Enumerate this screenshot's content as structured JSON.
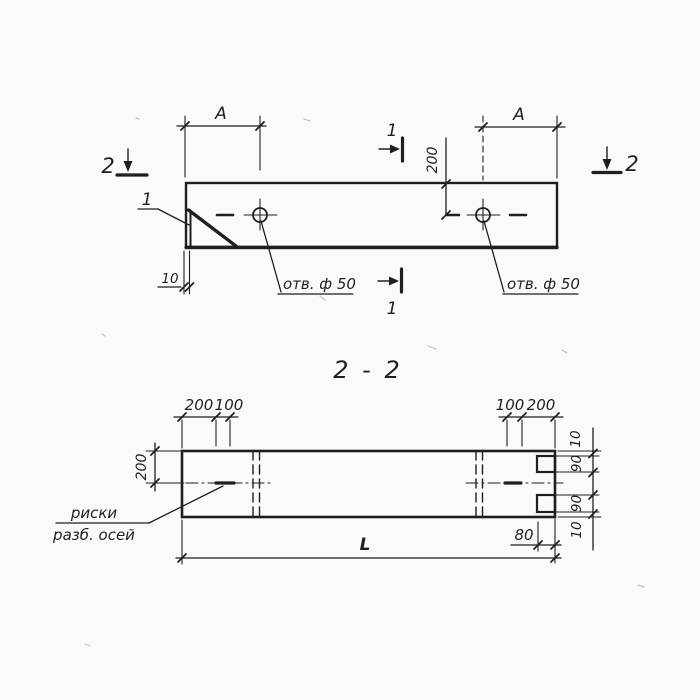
{
  "colors": {
    "background": "#fbfaf7",
    "ink": "#201f1d"
  },
  "top_view": {
    "section_cut_2_left": "2",
    "section_cut_2_right": "2",
    "section_cut_1_top": "1",
    "section_cut_1_bottom": "1",
    "detail_callout": "1",
    "dim_a_left": "A",
    "dim_a_right": "A",
    "dim_hole_offset": "200",
    "dim_plate_thickness": "10",
    "hole_label_left": "отв. ф 50",
    "hole_label_right": "отв. ф 50"
  },
  "section_view": {
    "title": "2 - 2",
    "dim_width": "200",
    "dim_top_left_200": "200",
    "dim_top_left_100": "100",
    "dim_top_right_100": "100",
    "dim_top_right_200": "200",
    "dim_right_top_10": "10",
    "dim_right_top_90": "90",
    "dim_right_bottom_90": "90",
    "dim_right_bottom_10": "10",
    "dim_notch_depth": "80",
    "dim_length": "L",
    "axes_note_line1": "риски",
    "axes_note_line2": "разб. осей"
  }
}
